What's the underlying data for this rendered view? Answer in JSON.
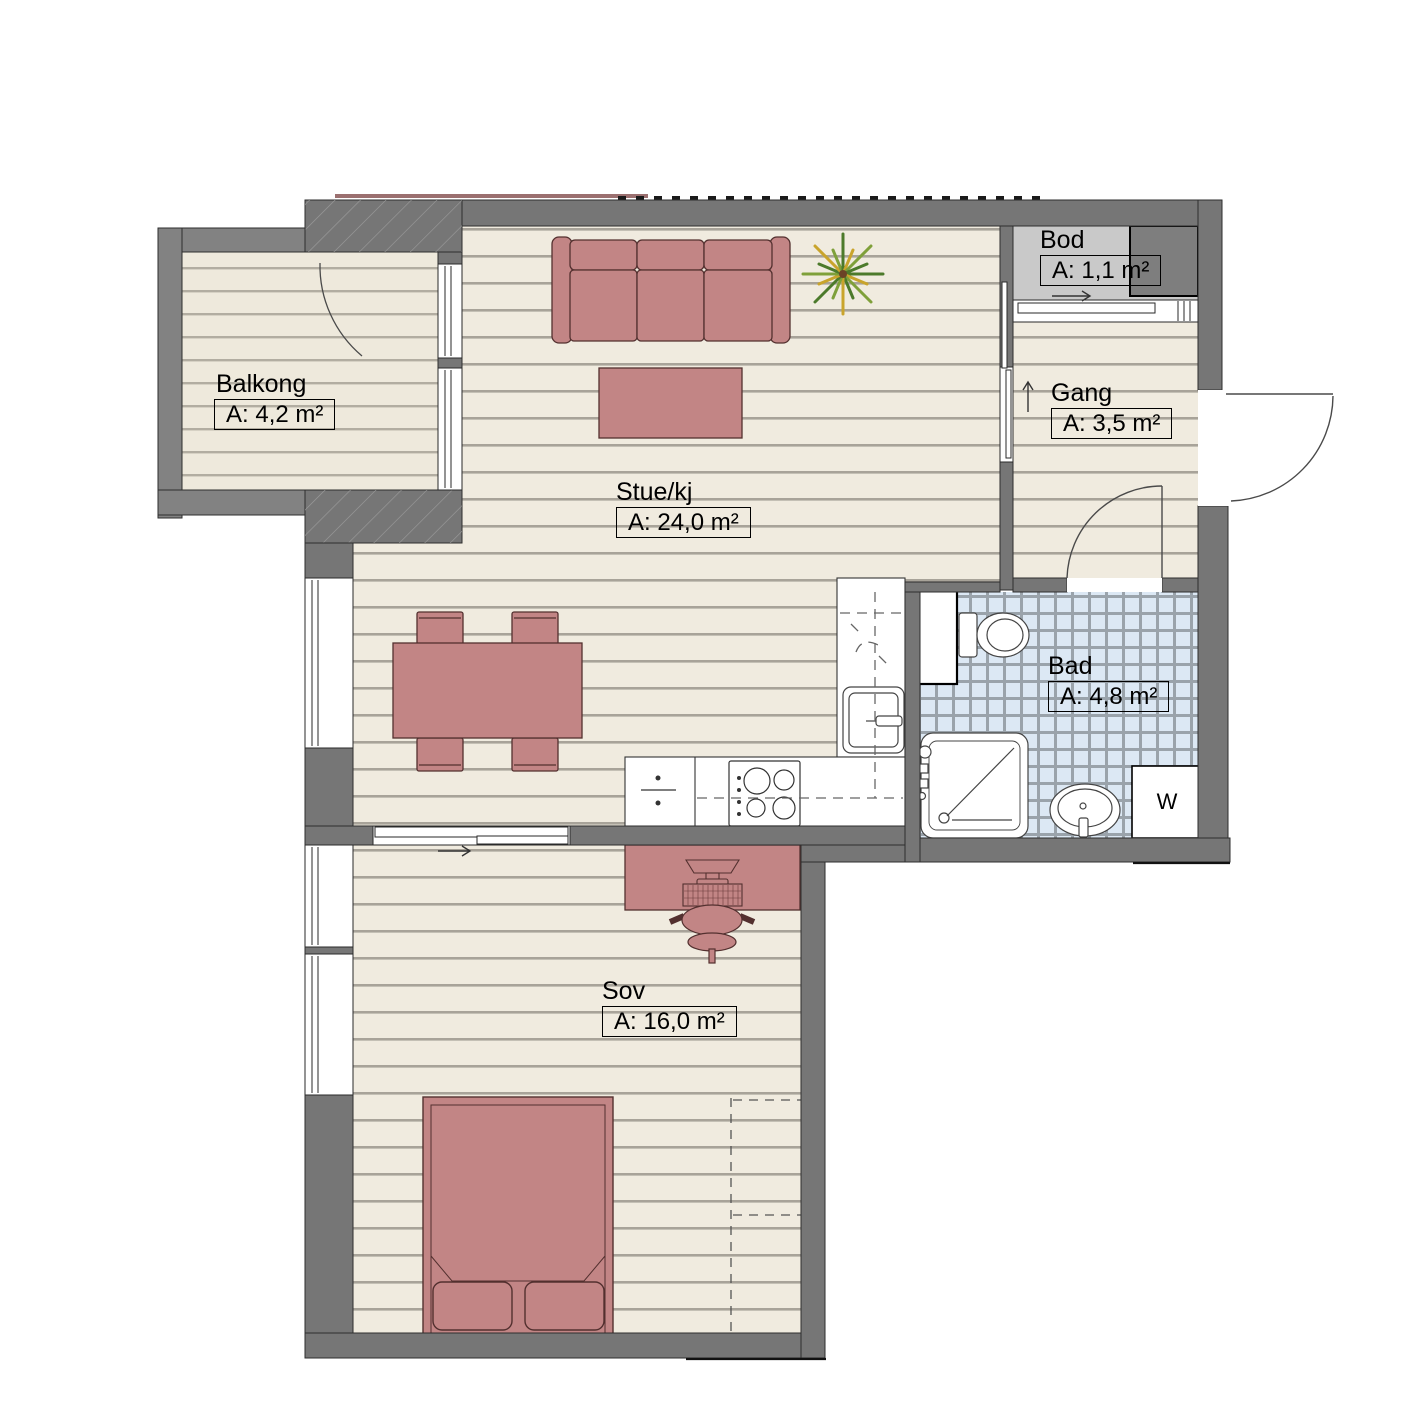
{
  "rooms": [
    {
      "key": "balkong",
      "name": "Balkong",
      "area": "A: 4,2 m²"
    },
    {
      "key": "stue",
      "name": "Stue/kj",
      "area": "A: 24,0 m²"
    },
    {
      "key": "bod",
      "name": "Bod",
      "area": "A: 1,1 m²"
    },
    {
      "key": "gang",
      "name": "Gang",
      "area": "A: 3,5 m²"
    },
    {
      "key": "bad",
      "name": "Bad",
      "area": "A: 4,8 m²"
    },
    {
      "key": "sov",
      "name": "Sov",
      "area": "A: 16,0 m²"
    }
  ],
  "appliances": {
    "washing_machine": "W"
  },
  "icons": {
    "bod_door_direction": "arrow-right-icon",
    "gang_entry_direction": "arrow-up-icon",
    "sov_door_direction": "arrow-right-icon",
    "plant": "potted-plant-icon"
  },
  "colors": {
    "wall": "#767676",
    "balcony_wall": "#828282",
    "furniture": "#c28585",
    "furniture_outline": "#53302f",
    "wood_floor": "#f0ebdf",
    "wood_line": "#a8a399",
    "tile": "#dce8f4",
    "tile_grout": "#9aa3ab",
    "storage_floor": "#c9c9c9",
    "plant_green": "#4c7a2b",
    "plant_yellow": "#c9a42c"
  }
}
